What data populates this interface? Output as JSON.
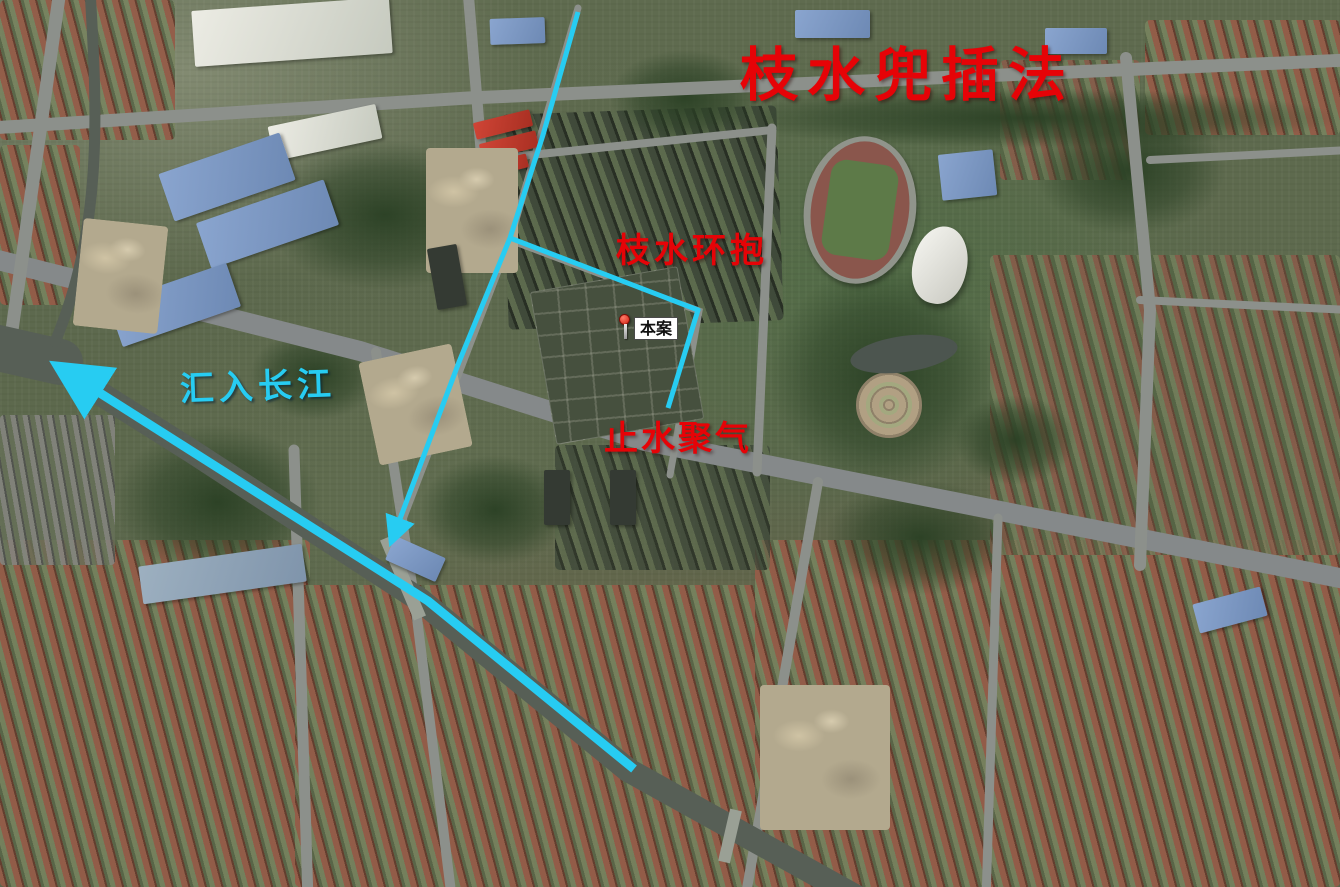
{
  "map_type": "satellite-annotated",
  "colors": {
    "annotation_red": "#e60307",
    "flow_cyan": "#27ccf2",
    "river_gray": "#575f56",
    "road_gray": "#8c908b",
    "marker_pin_red": "#d01f10"
  },
  "annotations": {
    "method_title": {
      "text": "枝水兜插法"
    },
    "branch_embrace": {
      "text": "枝水环抱"
    },
    "still_water_gather": {
      "text": "止水聚气"
    },
    "join_yangtze": {
      "text": "汇入长江"
    }
  },
  "marker": {
    "label": "本案"
  },
  "overlay": {
    "lines": [
      {
        "name": "main-flow-line",
        "points": [
          [
            578,
            12
          ],
          [
            543,
            135
          ],
          [
            510,
            238
          ],
          [
            459,
            362
          ],
          [
            392,
            540
          ]
        ],
        "width": 5,
        "arrow": "small"
      },
      {
        "name": "branch-flow-line",
        "points": [
          [
            510,
            238
          ],
          [
            698,
            310
          ],
          [
            668,
            408
          ]
        ],
        "width": 5,
        "arrow": "none"
      },
      {
        "name": "river-flow-line",
        "points": [
          [
            634,
            769
          ],
          [
            428,
            601
          ],
          [
            62,
            369
          ]
        ],
        "width": 9,
        "arrow": "large"
      }
    ]
  }
}
